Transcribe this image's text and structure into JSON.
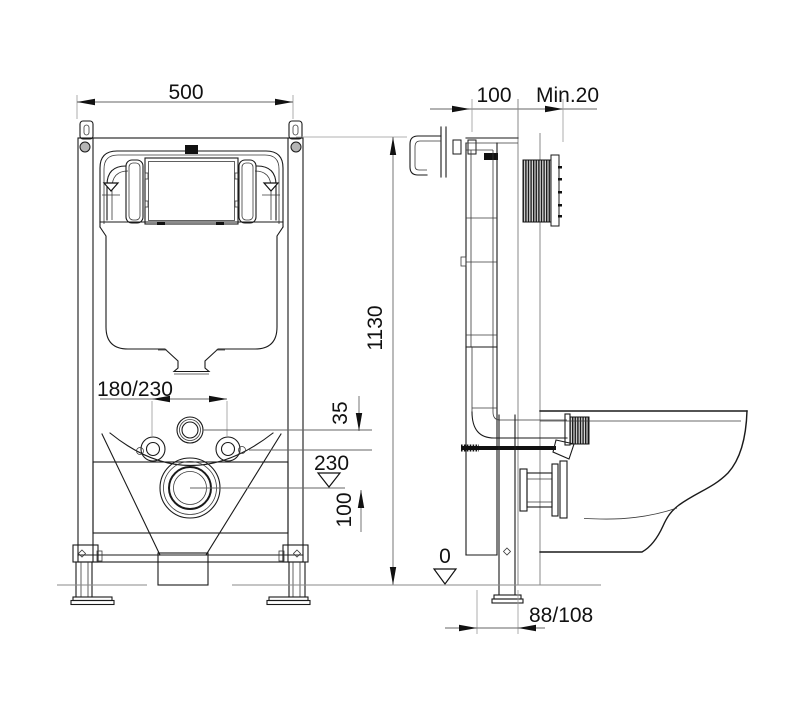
{
  "drawing": {
    "title": "Concealed cistern wall-frame installation drawing",
    "front_view": {
      "dim_width": "500",
      "dim_height": "1130",
      "dim_bolt_spacing": "180/230",
      "dim_flush_offset": "35",
      "dim_outlet_level": "230",
      "dim_outlet_offset": "100"
    },
    "side_view": {
      "dim_frame_depth": "100",
      "dim_wall_min": "Min.20",
      "dim_floor_level": "0",
      "dim_drain_distance": "88/108"
    }
  }
}
